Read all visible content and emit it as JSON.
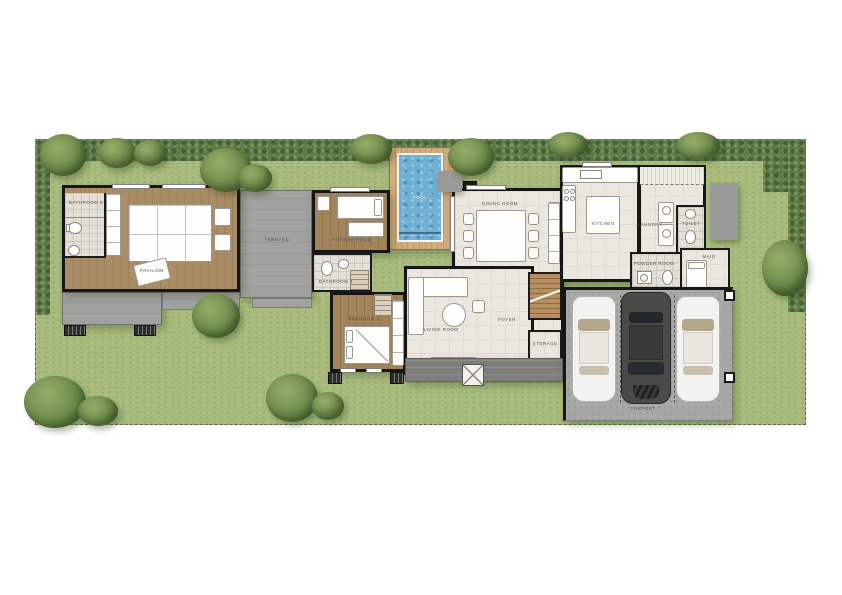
{
  "rooms": {
    "pavilion": "PAVILION",
    "bathroom5": "BATHROOM 5",
    "terrace": "TERRACE",
    "pool": "POOL",
    "fitness": "FITNESS ROOM",
    "bathroom4": "BATHROOM 4",
    "bedroom4": "BEDROOM 4",
    "dining": "DINING ROOM",
    "kitchen": "KITCHEN",
    "laundry": "LAUNDRY",
    "toilet": "TOILET",
    "powder": "POWDER ROOM",
    "maid": "MAID",
    "living": "LIVING ROOM",
    "foyer": "FOYER",
    "storage": "STORAGE",
    "carport": "CARPORT"
  },
  "colors": {
    "lawn": "#a9bc7e",
    "hedge": "#5e7847",
    "pool_water": "#6fb0d3",
    "pool_deck": "#c8a06f",
    "wood_floor": "#a5885f",
    "tile_floor": "#dedad1",
    "interior_floor": "#ebe7de",
    "terrace_deck": "#9c9c9a",
    "concrete": "#a8a8a6",
    "wall": "#1a1a1a",
    "car_white": "#f2f2f0",
    "car_dark": "#4a4a48",
    "label_text": "#54544c"
  }
}
